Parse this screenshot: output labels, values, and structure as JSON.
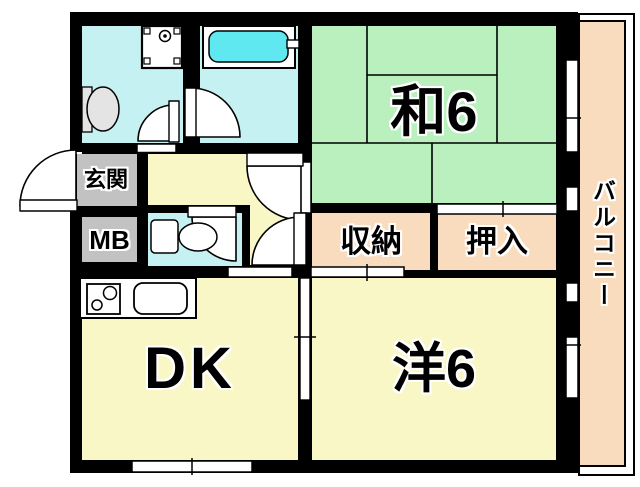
{
  "floorplan": {
    "type": "apartment-floor-plan",
    "rooms": {
      "washitsu": {
        "label": "和6",
        "description": "japanese-tatami-room-6-mats"
      },
      "western": {
        "label": "洋6",
        "description": "western-room-6-mats"
      },
      "dk": {
        "label": "DK",
        "description": "dining-kitchen"
      },
      "genkan": {
        "label": "玄関",
        "description": "entrance"
      },
      "meter_box": {
        "label": "MB",
        "description": "meter-box"
      },
      "storage": {
        "label": "収納",
        "description": "storage"
      },
      "closet": {
        "label": "押入",
        "description": "futon-closet"
      },
      "balcony": {
        "label": "バルコニー",
        "description": "balcony"
      }
    },
    "fixtures": [
      "bathtub",
      "washing-machine-pan",
      "wash-basin",
      "toilet",
      "kitchen-counter",
      "stove-burners",
      "kitchen-sink",
      "door-swing-arcs",
      "window-openings",
      "tatami-mat-lines"
    ],
    "palette": {
      "wall": "#000000",
      "cyan": "#C6F1F2",
      "tub": "#5FE8EF",
      "green": "#B9F0BE",
      "yellow": "#FAF7C6",
      "peach": "#F8DCBD",
      "gray": "#C2C2C2",
      "fixgray": "#E4E4E4",
      "bg": "#FFFFFF"
    }
  }
}
